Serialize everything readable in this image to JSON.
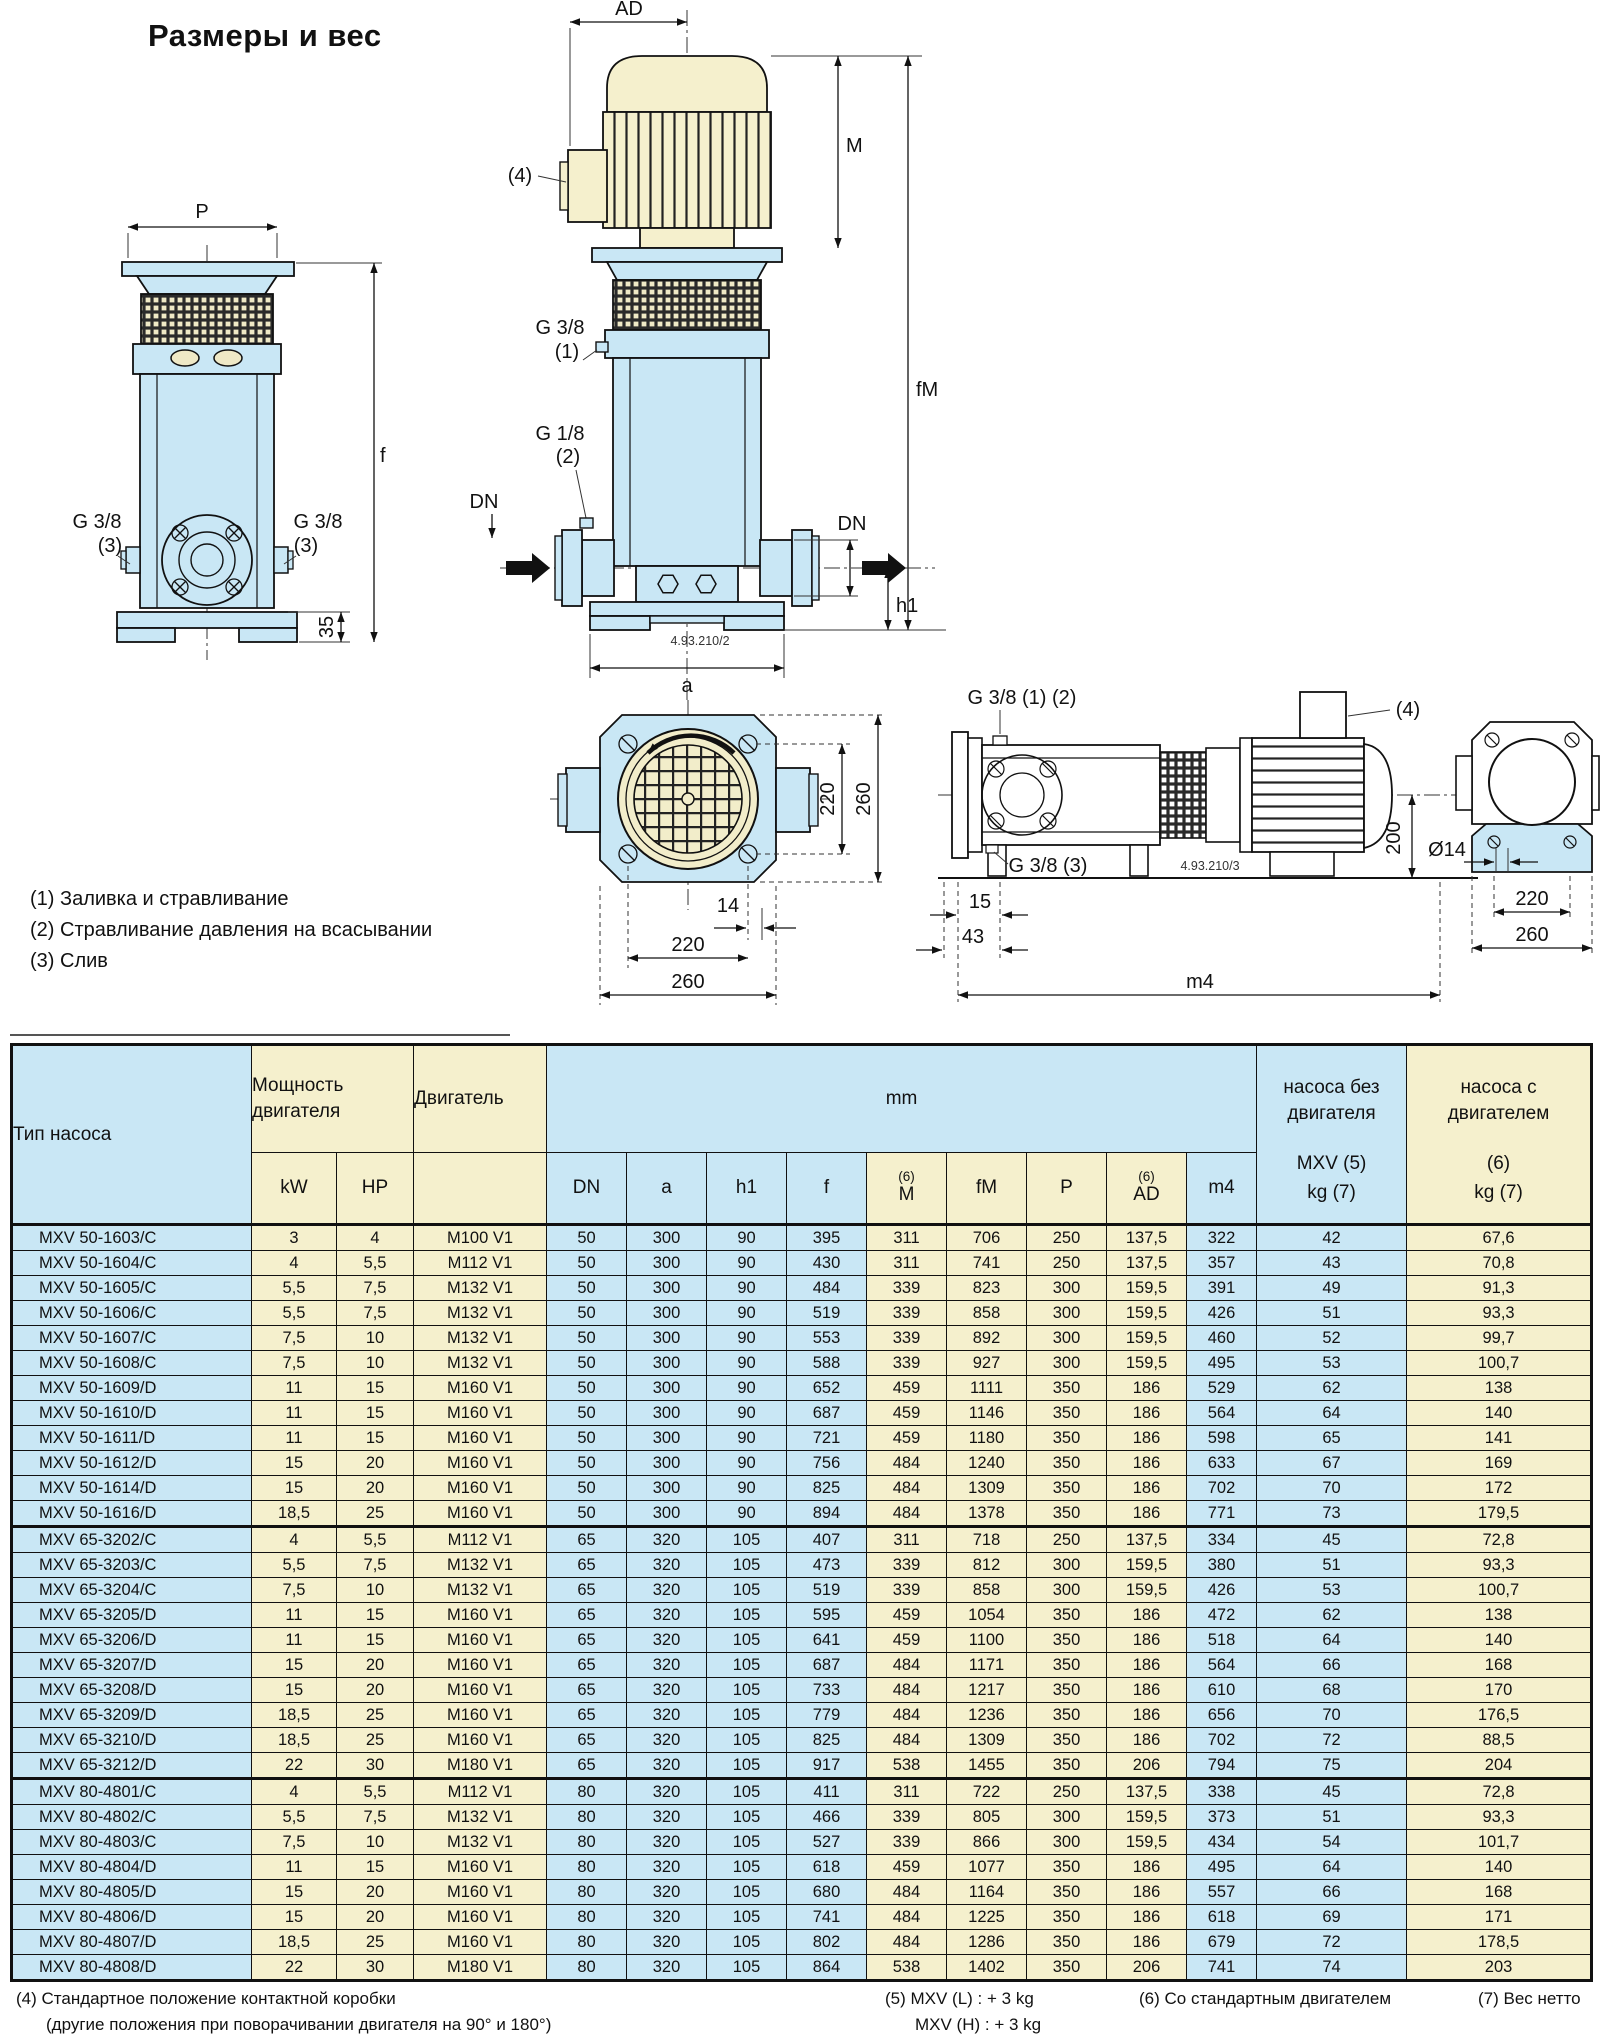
{
  "page": {
    "title": "Размеры и вес"
  },
  "colors": {
    "blue": "#c9e7f5",
    "cream": "#f5f0cd",
    "line": "#111111"
  },
  "legend": {
    "items": [
      "(1) Заливка и стравливание",
      "(2) Стравливание давления на всасывании",
      "(3) Слив"
    ]
  },
  "drawings": {
    "bare": {
      "p": "P",
      "f": "f",
      "d35": "35",
      "g38": "G 3/8",
      "n3": "(3)"
    },
    "vert": {
      "ad": "AD",
      "n4": "(4)",
      "m": "M",
      "fm": "fM",
      "g38": "G 3/8",
      "n1": "(1)",
      "g18": "G 1/8",
      "n2": "(2)",
      "dn": "DN",
      "h1": "h1",
      "a": "a",
      "code": "4.93.210/2"
    },
    "top": {
      "v220": "220",
      "v260": "260",
      "d14": "14",
      "h220": "220",
      "h260": "260"
    },
    "horiz": {
      "g3812": "G 3/8 (1) (2)",
      "n4": "(4)",
      "g383": "G 3/8 (3)",
      "code": "4.93.210/3",
      "d15": "15",
      "d43": "43",
      "m4": "m4",
      "d200": "200",
      "dia": "Ø14"
    },
    "end": {
      "d220": "220",
      "d260": "260"
    }
  },
  "table": {
    "header": {
      "pump_type": "Тип насоса",
      "power_1": "Мощность",
      "power_2": "двигателя",
      "motor": "Двигатель",
      "kw": "kW",
      "hp": "HP",
      "mm": "mm",
      "dims": [
        "DN",
        "a",
        "h1",
        "f",
        "M",
        "fM",
        "P",
        "AD",
        "m4"
      ],
      "sup6": "(6)",
      "bare_1": "насоса без",
      "bare_2": "двигателя",
      "bare_3": "MXV (5)",
      "bare_4": "kg (7)",
      "with_1": "насоса с",
      "with_2": "двигателем",
      "with_3": "(6)",
      "with_4": "kg (7)"
    },
    "groups": [
      {
        "rows": [
          [
            "MXV 50-1603/C",
            "3",
            "4",
            "M100 V1",
            "50",
            "300",
            "90",
            "395",
            "311",
            "706",
            "250",
            "137,5",
            "322",
            "42",
            "67,6"
          ],
          [
            "MXV 50-1604/C",
            "4",
            "5,5",
            "M112 V1",
            "50",
            "300",
            "90",
            "430",
            "311",
            "741",
            "250",
            "137,5",
            "357",
            "43",
            "70,8"
          ],
          [
            "MXV 50-1605/C",
            "5,5",
            "7,5",
            "M132 V1",
            "50",
            "300",
            "90",
            "484",
            "339",
            "823",
            "300",
            "159,5",
            "391",
            "49",
            "91,3"
          ],
          [
            "MXV 50-1606/C",
            "5,5",
            "7,5",
            "M132 V1",
            "50",
            "300",
            "90",
            "519",
            "339",
            "858",
            "300",
            "159,5",
            "426",
            "51",
            "93,3"
          ],
          [
            "MXV 50-1607/C",
            "7,5",
            "10",
            "M132 V1",
            "50",
            "300",
            "90",
            "553",
            "339",
            "892",
            "300",
            "159,5",
            "460",
            "52",
            "99,7"
          ],
          [
            "MXV 50-1608/C",
            "7,5",
            "10",
            "M132 V1",
            "50",
            "300",
            "90",
            "588",
            "339",
            "927",
            "300",
            "159,5",
            "495",
            "53",
            "100,7"
          ],
          [
            "MXV 50-1609/D",
            "11",
            "15",
            "M160 V1",
            "50",
            "300",
            "90",
            "652",
            "459",
            "1111",
            "350",
            "186",
            "529",
            "62",
            "138"
          ],
          [
            "MXV 50-1610/D",
            "11",
            "15",
            "M160 V1",
            "50",
            "300",
            "90",
            "687",
            "459",
            "1146",
            "350",
            "186",
            "564",
            "64",
            "140"
          ],
          [
            "MXV 50-1611/D",
            "11",
            "15",
            "M160 V1",
            "50",
            "300",
            "90",
            "721",
            "459",
            "1180",
            "350",
            "186",
            "598",
            "65",
            "141"
          ],
          [
            "MXV 50-1612/D",
            "15",
            "20",
            "M160 V1",
            "50",
            "300",
            "90",
            "756",
            "484",
            "1240",
            "350",
            "186",
            "633",
            "67",
            "169"
          ],
          [
            "MXV 50-1614/D",
            "15",
            "20",
            "M160 V1",
            "50",
            "300",
            "90",
            "825",
            "484",
            "1309",
            "350",
            "186",
            "702",
            "70",
            "172"
          ],
          [
            "MXV 50-1616/D",
            "18,5",
            "25",
            "M160 V1",
            "50",
            "300",
            "90",
            "894",
            "484",
            "1378",
            "350",
            "186",
            "771",
            "73",
            "179,5"
          ]
        ]
      },
      {
        "rows": [
          [
            "MXV 65-3202/C",
            "4",
            "5,5",
            "M112 V1",
            "65",
            "320",
            "105",
            "407",
            "311",
            "718",
            "250",
            "137,5",
            "334",
            "45",
            "72,8"
          ],
          [
            "MXV 65-3203/C",
            "5,5",
            "7,5",
            "M132 V1",
            "65",
            "320",
            "105",
            "473",
            "339",
            "812",
            "300",
            "159,5",
            "380",
            "51",
            "93,3"
          ],
          [
            "MXV 65-3204/C",
            "7,5",
            "10",
            "M132 V1",
            "65",
            "320",
            "105",
            "519",
            "339",
            "858",
            "300",
            "159,5",
            "426",
            "53",
            "100,7"
          ],
          [
            "MXV 65-3205/D",
            "11",
            "15",
            "M160 V1",
            "65",
            "320",
            "105",
            "595",
            "459",
            "1054",
            "350",
            "186",
            "472",
            "62",
            "138"
          ],
          [
            "MXV 65-3206/D",
            "11",
            "15",
            "M160 V1",
            "65",
            "320",
            "105",
            "641",
            "459",
            "1100",
            "350",
            "186",
            "518",
            "64",
            "140"
          ],
          [
            "MXV 65-3207/D",
            "15",
            "20",
            "M160 V1",
            "65",
            "320",
            "105",
            "687",
            "484",
            "1171",
            "350",
            "186",
            "564",
            "66",
            "168"
          ],
          [
            "MXV 65-3208/D",
            "15",
            "20",
            "M160 V1",
            "65",
            "320",
            "105",
            "733",
            "484",
            "1217",
            "350",
            "186",
            "610",
            "68",
            "170"
          ],
          [
            "MXV 65-3209/D",
            "18,5",
            "25",
            "M160 V1",
            "65",
            "320",
            "105",
            "779",
            "484",
            "1236",
            "350",
            "186",
            "656",
            "70",
            "176,5"
          ],
          [
            "MXV 65-3210/D",
            "18,5",
            "25",
            "M160 V1",
            "65",
            "320",
            "105",
            "825",
            "484",
            "1309",
            "350",
            "186",
            "702",
            "72",
            "88,5"
          ],
          [
            "MXV 65-3212/D",
            "22",
            "30",
            "M180 V1",
            "65",
            "320",
            "105",
            "917",
            "538",
            "1455",
            "350",
            "206",
            "794",
            "75",
            "204"
          ]
        ]
      },
      {
        "rows": [
          [
            "MXV 80-4801/C",
            "4",
            "5,5",
            "M112 V1",
            "80",
            "320",
            "105",
            "411",
            "311",
            "722",
            "250",
            "137,5",
            "338",
            "45",
            "72,8"
          ],
          [
            "MXV 80-4802/C",
            "5,5",
            "7,5",
            "M132 V1",
            "80",
            "320",
            "105",
            "466",
            "339",
            "805",
            "300",
            "159,5",
            "373",
            "51",
            "93,3"
          ],
          [
            "MXV 80-4803/C",
            "7,5",
            "10",
            "M132 V1",
            "80",
            "320",
            "105",
            "527",
            "339",
            "866",
            "300",
            "159,5",
            "434",
            "54",
            "101,7"
          ],
          [
            "MXV 80-4804/D",
            "11",
            "15",
            "M160 V1",
            "80",
            "320",
            "105",
            "618",
            "459",
            "1077",
            "350",
            "186",
            "495",
            "64",
            "140"
          ],
          [
            "MXV 80-4805/D",
            "15",
            "20",
            "M160 V1",
            "80",
            "320",
            "105",
            "680",
            "484",
            "1164",
            "350",
            "186",
            "557",
            "66",
            "168"
          ],
          [
            "MXV 80-4806/D",
            "15",
            "20",
            "M160 V1",
            "80",
            "320",
            "105",
            "741",
            "484",
            "1225",
            "350",
            "186",
            "618",
            "69",
            "171"
          ],
          [
            "MXV 80-4807/D",
            "18,5",
            "25",
            "M160 V1",
            "80",
            "320",
            "105",
            "802",
            "484",
            "1286",
            "350",
            "186",
            "679",
            "72",
            "178,5"
          ],
          [
            "MXV 80-4808/D",
            "22",
            "30",
            "M180 V1",
            "80",
            "320",
            "105",
            "864",
            "538",
            "1402",
            "350",
            "206",
            "741",
            "74",
            "203"
          ]
        ]
      }
    ]
  },
  "footnotes": {
    "n4a": "(4) Стандартное положение контактной коробки",
    "n4b": "(другие положения при поворачивании двигателя на 90° и 180°)",
    "n5a": "(5) MXV (L) : + 3 kg",
    "n5b": "MXV (H) : + 3 kg",
    "n6": "(6) Со стандартным двигателем",
    "n7": "(7) Вес нетто"
  }
}
